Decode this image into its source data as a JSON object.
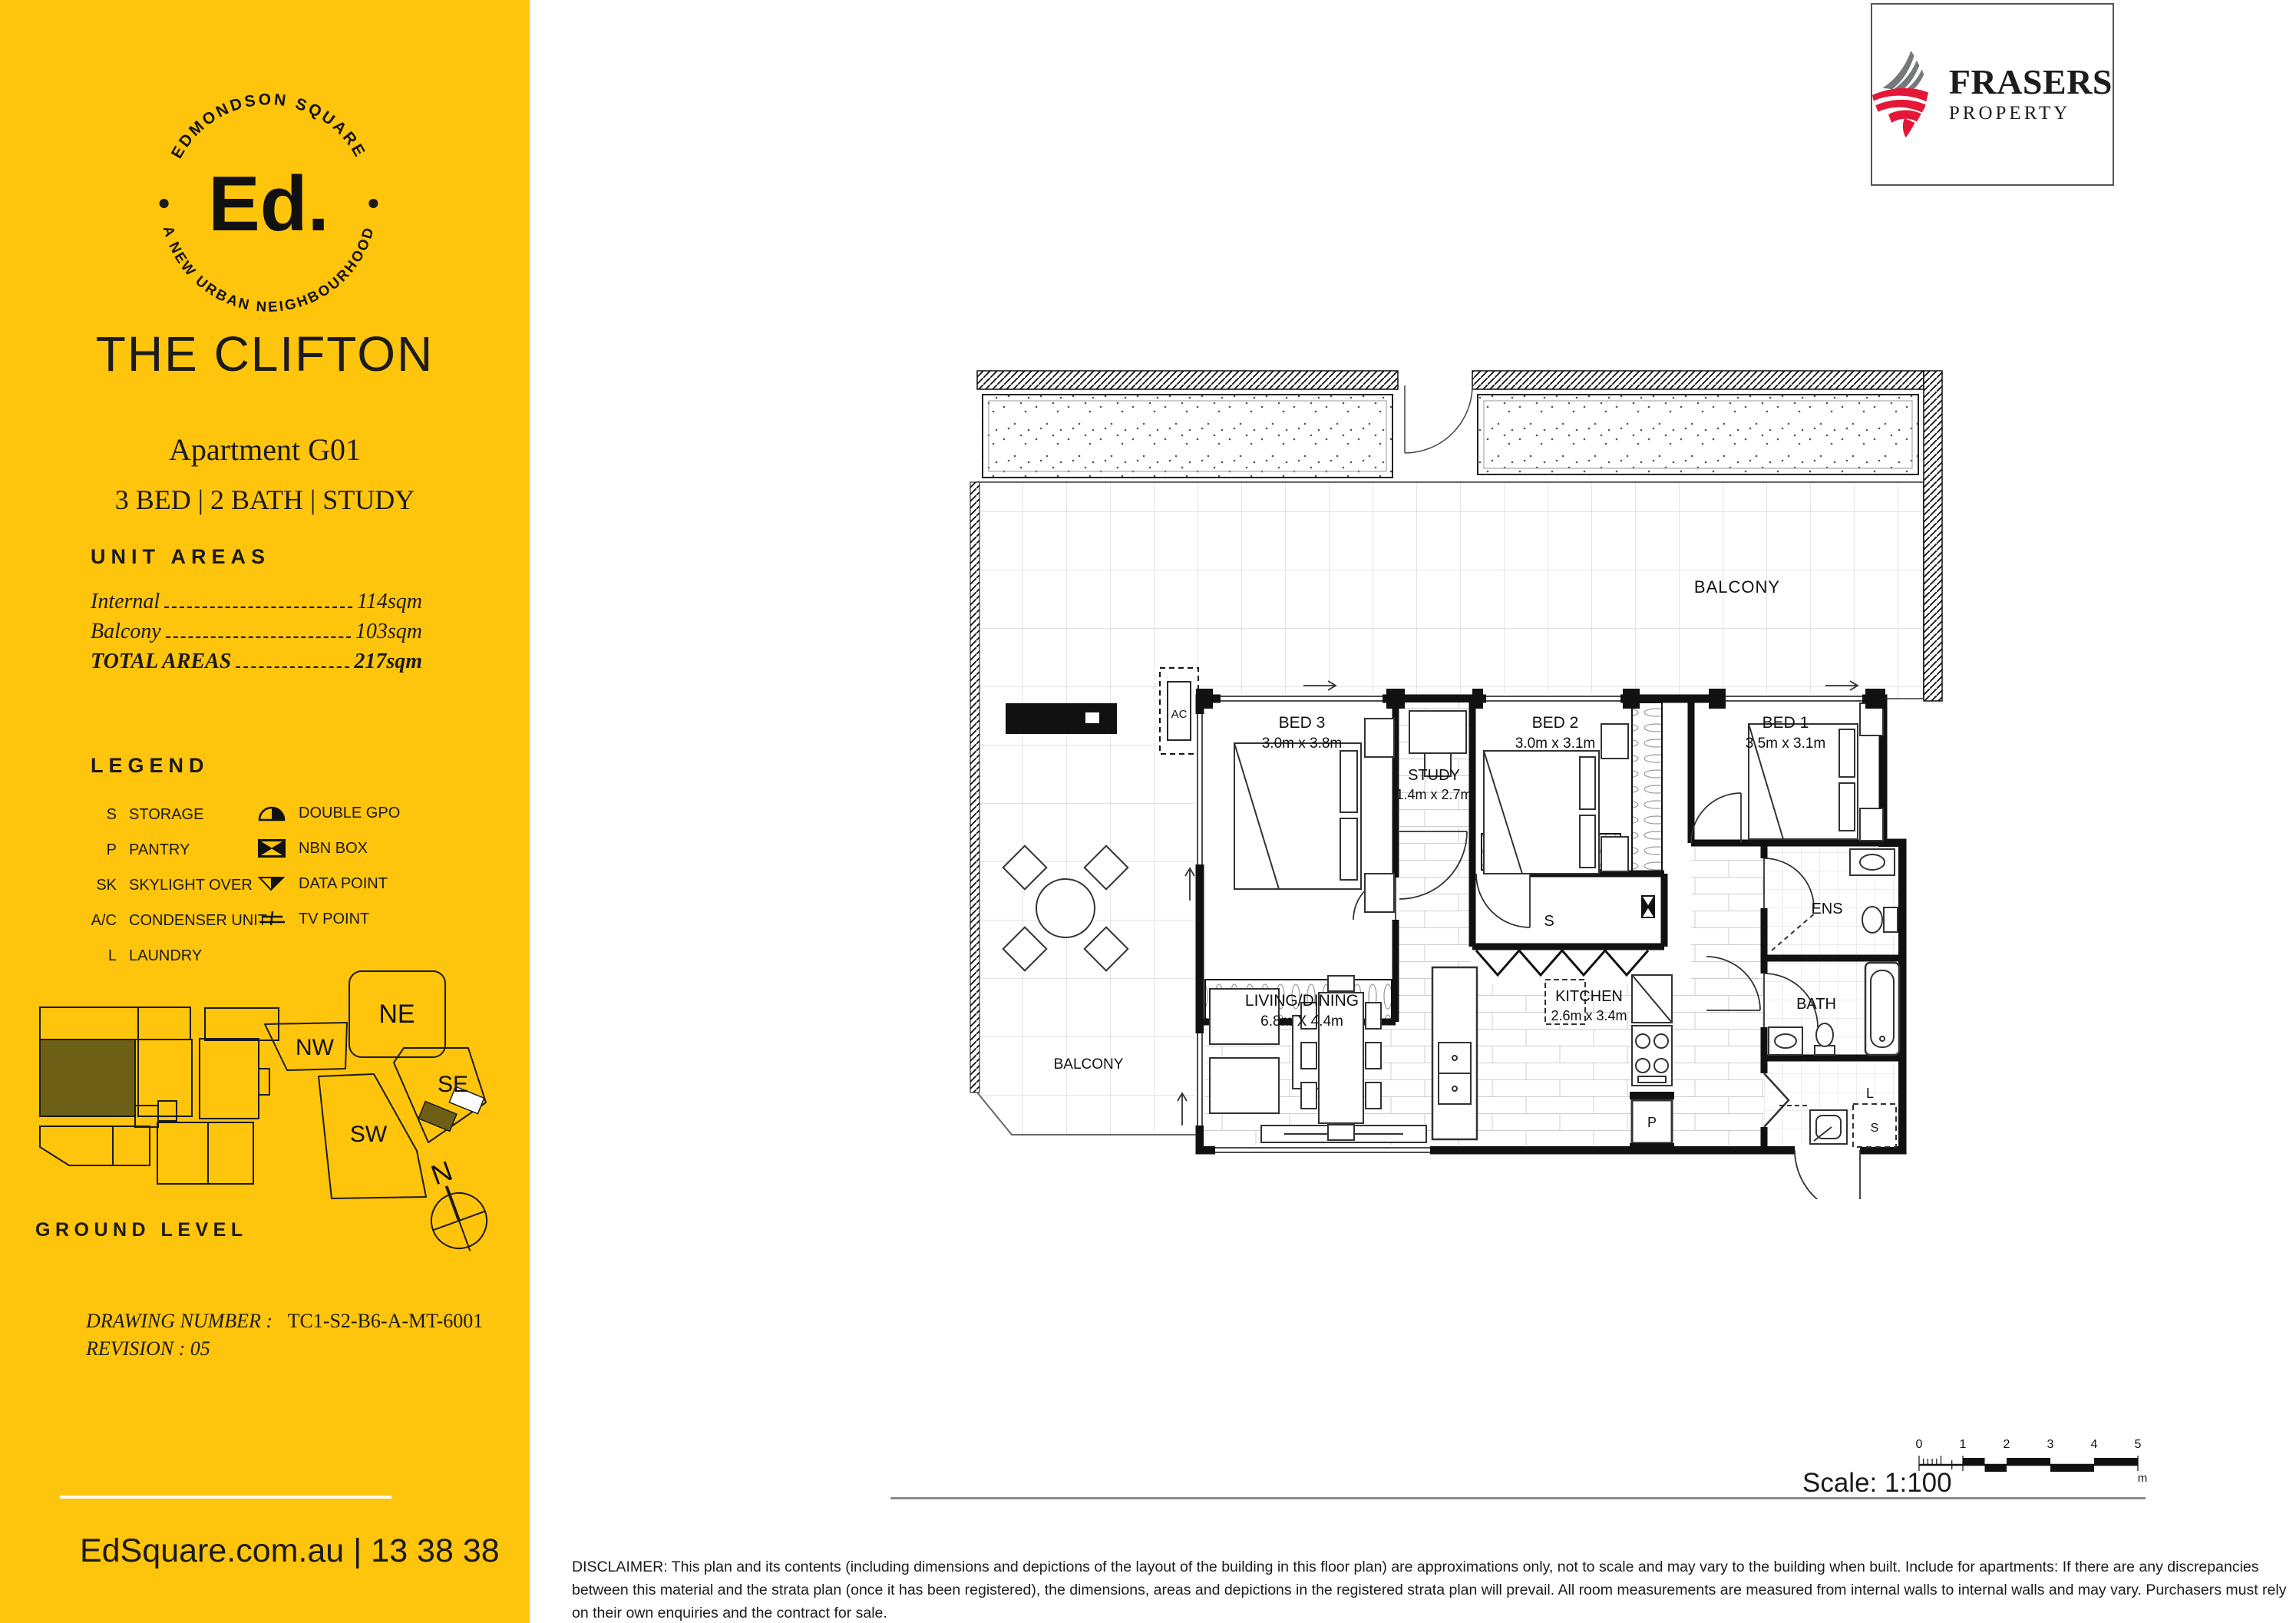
{
  "colors": {
    "sidebar_yellow": "#FFC40C",
    "keyplan_highlight": "#6E5F17",
    "brand_red": "#E31837",
    "brand_gray": "#77787B"
  },
  "sidebar": {
    "logo": {
      "ring_top": "EDMONDSON SQUARE",
      "ring_bottom": "A NEW URBAN NEIGHBOURHOOD",
      "monogram": "Ed."
    },
    "title": "THE CLIFTON",
    "apartment": "Apartment G01",
    "configuration": "3 BED | 2 BATH | STUDY",
    "unit_areas": {
      "heading": "UNIT AREAS",
      "rows": [
        {
          "label": "Internal",
          "value": "114sqm"
        },
        {
          "label": "Balcony",
          "value": "103sqm"
        },
        {
          "label": "TOTAL AREAS",
          "value": "217sqm"
        }
      ]
    },
    "legend": {
      "heading": "LEGEND",
      "abbreviations": [
        {
          "key": "S",
          "label": "STORAGE"
        },
        {
          "key": "P",
          "label": "PANTRY"
        },
        {
          "key": "SK",
          "label": "SKYLIGHT OVER"
        },
        {
          "key": "A/C",
          "label": "CONDENSER UNIT"
        },
        {
          "key": "L",
          "label": "LAUNDRY"
        }
      ],
      "symbols": [
        {
          "icon": "double-gpo-icon",
          "label": "DOUBLE GPO"
        },
        {
          "icon": "nbn-box-icon",
          "label": "NBN BOX"
        },
        {
          "icon": "data-point-icon",
          "label": "DATA POINT"
        },
        {
          "icon": "tv-point-icon",
          "label": "TV POINT"
        }
      ]
    },
    "keyplan": {
      "level": "GROUND LEVEL",
      "quadrants": {
        "ne": "NE",
        "nw": "NW",
        "se": "SE",
        "sw": "SW"
      },
      "compass": "N"
    },
    "drawing": {
      "number_label": "DRAWING NUMBER :",
      "number": "TC1-S2-B6-A-MT-6001",
      "revision": "REVISION : 05"
    },
    "footer": "EdSquare.com.au  |  13 38 38"
  },
  "brand": {
    "name": "FRASERS",
    "sub": "PROPERTY"
  },
  "floorplan": {
    "balcony_top": "BALCONY",
    "balcony_left": "BALCONY",
    "bed3": {
      "name": "BED 3",
      "dims": "3.0m x 3.8m"
    },
    "study": {
      "name": "STUDY",
      "dims": "1.4m x 2.7m"
    },
    "bed2": {
      "name": "BED 2",
      "dims": "3.0m x 3.1m"
    },
    "bed1": {
      "name": "BED 1",
      "dims": "3.5m x 3.1m"
    },
    "living": {
      "name": "LIVING/DINING",
      "dims": "6.8m X 4.4m"
    },
    "kitchen": {
      "name": "KITCHEN",
      "dims": "2.6m x 3.4m"
    },
    "ens": "ENS",
    "bath": "BATH",
    "markers": {
      "storage": "S",
      "pantry": "P",
      "laundry": "L",
      "laundry_storage": "S",
      "ac": "AC"
    }
  },
  "scalebar": {
    "label": "Scale: 1:100",
    "ticks": [
      "0",
      "1",
      "2",
      "3",
      "4",
      "5"
    ],
    "unit": "m"
  },
  "disclaimer": "DISCLAIMER: This plan and its contents (including dimensions and depictions of the layout of the building in this floor plan) are approximations only, not to scale and may vary to the building when built. Include for apartments: If there are any discrepancies between this material and the strata plan (once it has been registered), the dimensions, areas and depictions in the registered strata plan will prevail. All room measurements are measured from internal walls to internal walls and may vary. Purchasers must rely on their own enquiries and the contract for sale."
}
